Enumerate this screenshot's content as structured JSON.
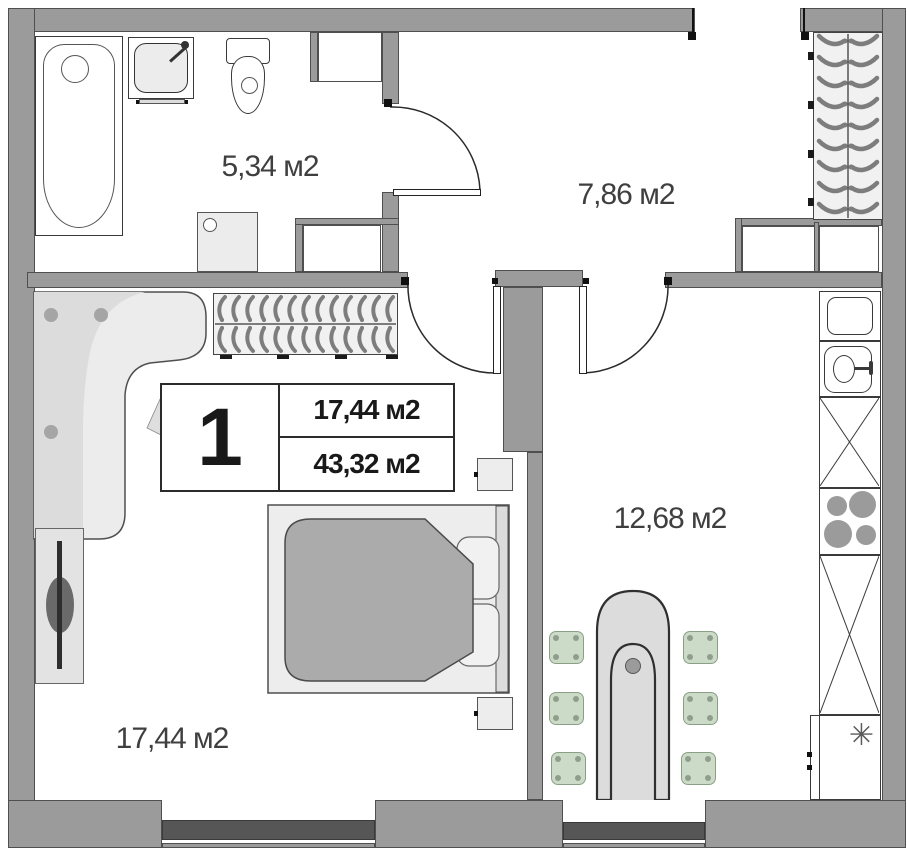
{
  "legend": {
    "unit_number": "1",
    "room_area": "17,44 м2",
    "total_area": "43,32 м2"
  },
  "room_labels": {
    "bathroom": "5,34 м2",
    "hallway": "7,86 м2",
    "living_room": "17,44 м2",
    "kitchen": "12,68 м2"
  },
  "icons": {
    "fridge_symbol": "✳"
  },
  "colors": {
    "wall": "#9b9b9b",
    "wall_outline": "#4f4f4f",
    "window_glass_bar": "#565656",
    "label_text": "#3f3f3f",
    "legend_text": "#191919",
    "chair": "#ccdbc8",
    "blanket": "#ababab",
    "table": "#dcdcdc",
    "hanger": "#7d7d7d"
  }
}
